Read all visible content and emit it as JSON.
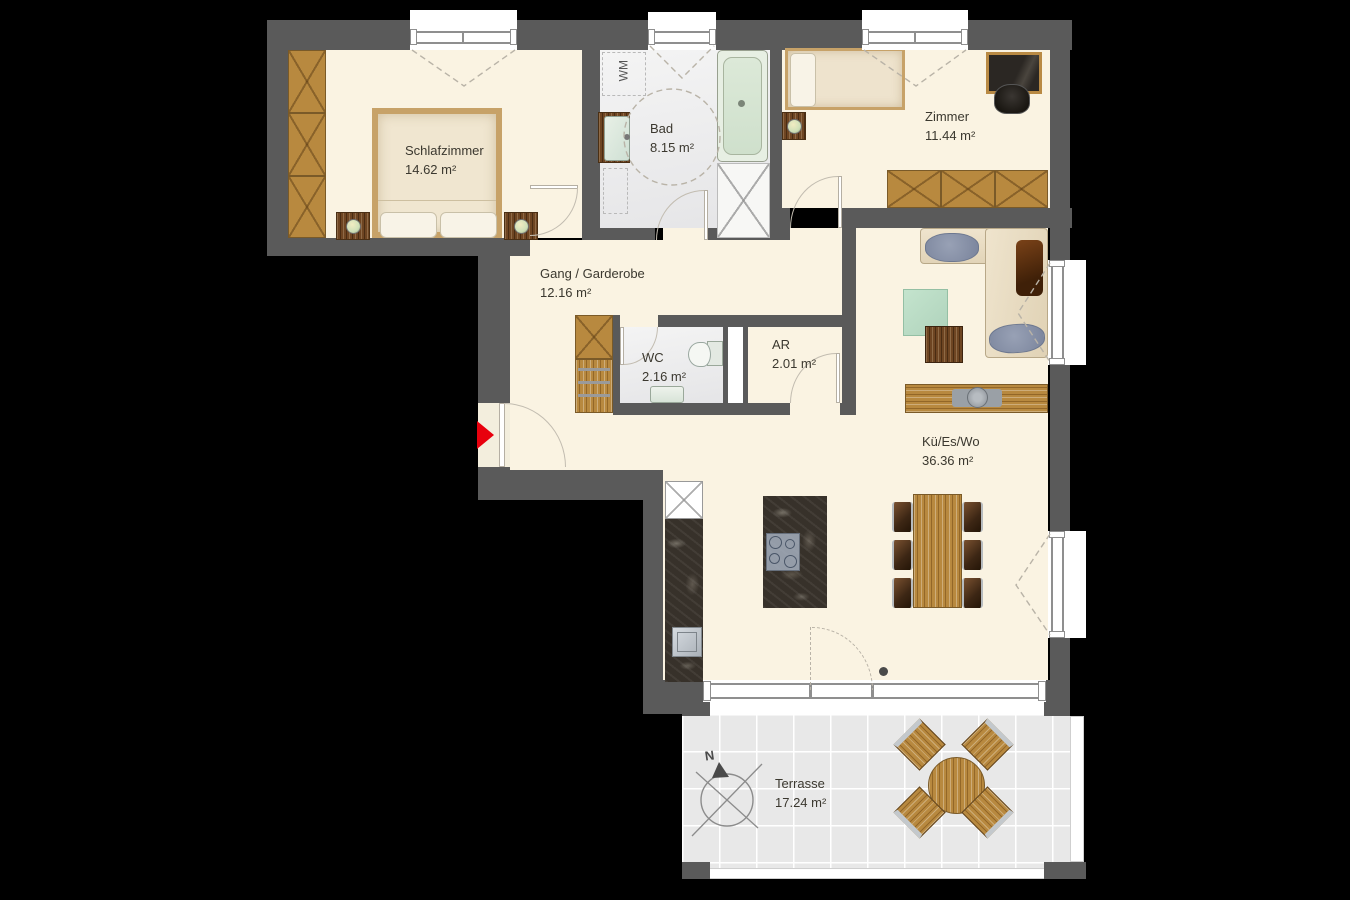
{
  "plan": {
    "title": "Apartment floor plan",
    "colors": {
      "background": "#000000",
      "wall": "#5a5a5a",
      "floor_main": "#faf3e2",
      "floor_wet": "#ececec",
      "floor_terrace": "#e8e8e8",
      "wood": "#b8893f",
      "counter_dark": "#37312a",
      "entrance_arrow": "#e8000d",
      "text": "#3b382f"
    },
    "rooms": [
      {
        "id": "schlafzimmer",
        "name": "Schlafzimmer",
        "area": "14.62 m²"
      },
      {
        "id": "bad",
        "name": "Bad",
        "area": "8.15 m²"
      },
      {
        "id": "zimmer",
        "name": "Zimmer",
        "area": "11.44 m²"
      },
      {
        "id": "gang",
        "name": "Gang / Garderobe",
        "area": "12.16 m²"
      },
      {
        "id": "wc",
        "name": "WC",
        "area": "2.16 m²"
      },
      {
        "id": "ar",
        "name": "AR",
        "area": "2.01 m²"
      },
      {
        "id": "kueswo",
        "name": "Kü/Es/Wo",
        "area": "36.36 m²"
      },
      {
        "id": "terrasse",
        "name": "Terrasse",
        "area": "17.24 m²"
      }
    ],
    "labels": {
      "washing_machine": "WM",
      "compass_north": "N"
    }
  }
}
